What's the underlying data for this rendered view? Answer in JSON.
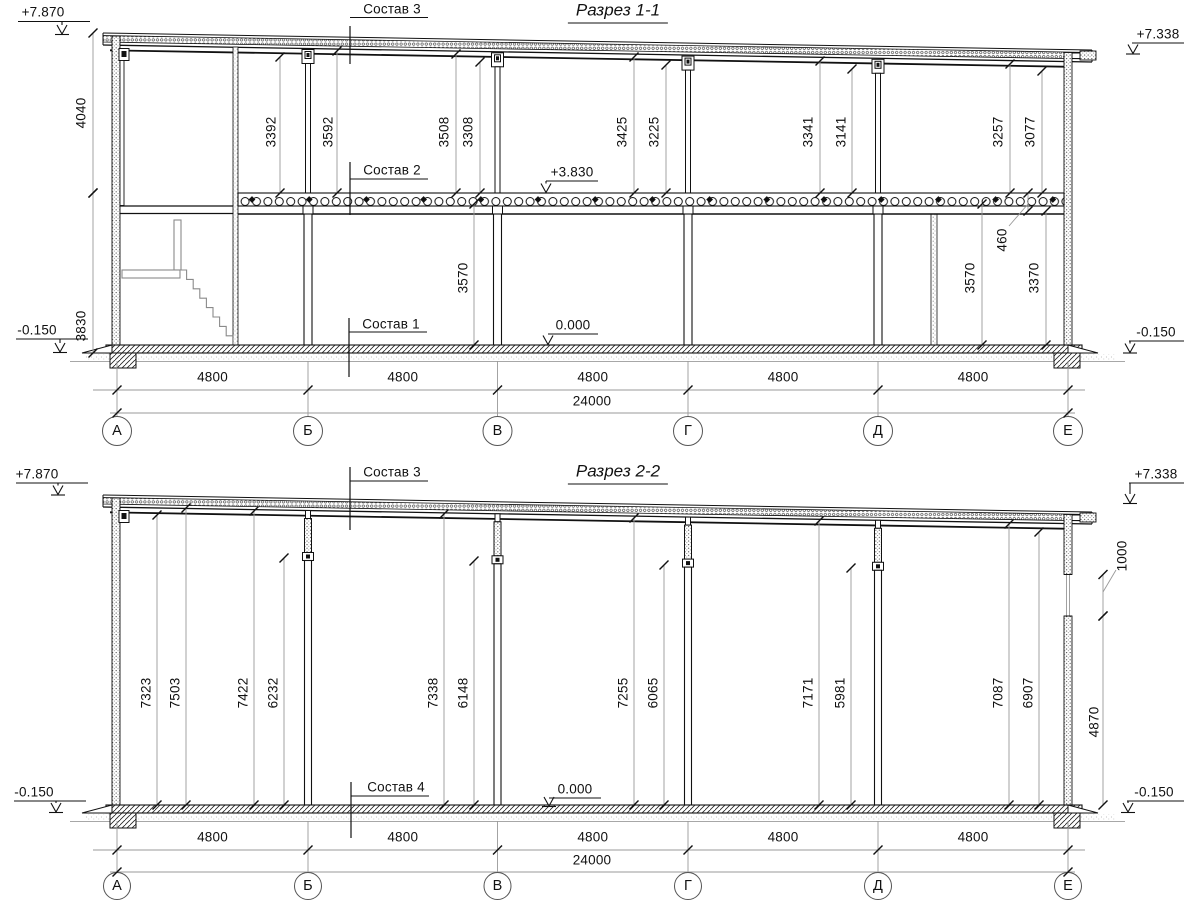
{
  "sections": [
    {
      "title": "Разрез 1-1",
      "axes": [
        "А",
        "Б",
        "В",
        "Г",
        "Д",
        "Е"
      ],
      "bay_dims": [
        "4800",
        "4800",
        "4800",
        "4800",
        "4800"
      ],
      "total_dim": "24000",
      "elevations": [
        "+7.870",
        "+7.338",
        "-0.150",
        "-0.150",
        "+3.830",
        "0.000"
      ],
      "layer_labels": [
        "Состав 3",
        "Состав 2",
        "Состав 1"
      ],
      "vertical_dims": [
        "4040",
        "3830",
        "3392",
        "3592",
        "3508",
        "3308",
        "3425",
        "3225",
        "3341",
        "3141",
        "3257",
        "3077",
        "3570",
        "460",
        "3570",
        "3370"
      ]
    },
    {
      "title": "Разрез 2-2",
      "axes": [
        "А",
        "Б",
        "В",
        "Г",
        "Д",
        "Е"
      ],
      "bay_dims": [
        "4800",
        "4800",
        "4800",
        "4800",
        "4800"
      ],
      "total_dim": "24000",
      "elevations": [
        "+7.870",
        "+7.338",
        "-0.150",
        "-0.150",
        "0.000"
      ],
      "layer_labels": [
        "Состав 3",
        "Состав 4"
      ],
      "vertical_dims": [
        "7323",
        "7503",
        "7422",
        "6232",
        "7338",
        "6148",
        "7255",
        "6065",
        "7171",
        "5981",
        "7087",
        "6907",
        "1000",
        "4870"
      ]
    }
  ]
}
